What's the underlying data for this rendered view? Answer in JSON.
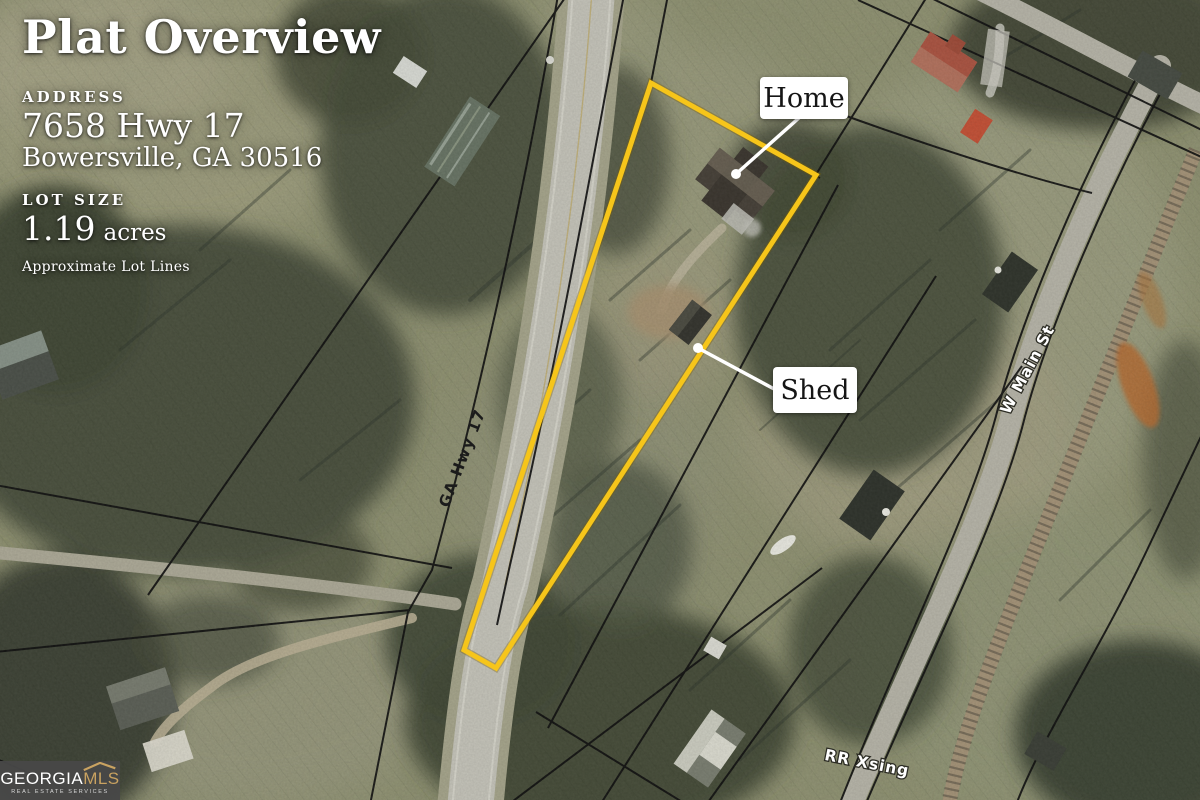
{
  "header": {
    "title": "Plat Overview",
    "address": {
      "label": "ADDRESS",
      "line1": "7658 Hwy 17",
      "line2": "Bowersville, GA 30516"
    },
    "lot": {
      "label": "LOT SIZE",
      "value": "1.19",
      "unit": "acres",
      "disclaimer": "Approximate Lot Lines"
    }
  },
  "map": {
    "markers": [
      {
        "id": "home",
        "label": "Home"
      },
      {
        "id": "shed",
        "label": "Shed"
      }
    ],
    "roads": {
      "highway": "GA Hwy 17",
      "main_street": "W Main St",
      "rr_crossing": "RR Xsing"
    },
    "colors": {
      "lot_outline": "#f6c51a",
      "parcel_line": "#101010",
      "road_label_light": "#ffffff",
      "road_label_dark": "#1b1b1b"
    }
  },
  "logo": {
    "brand": "GEORGIA",
    "suffix": "MLS",
    "tagline": "REAL ESTATE SERVICES"
  }
}
